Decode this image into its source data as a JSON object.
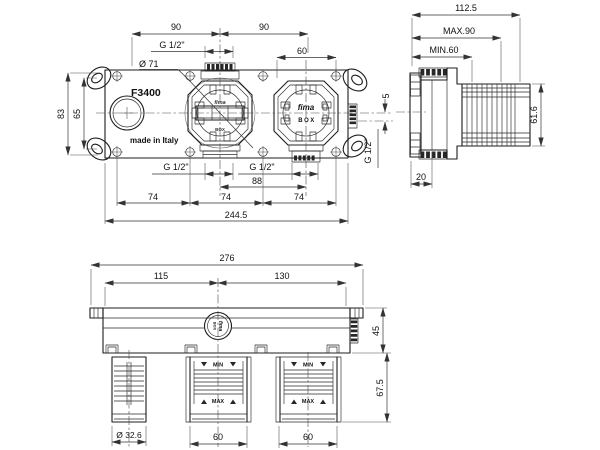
{
  "front_view": {
    "model_label": "F3400",
    "origin_label": "made in Italy",
    "valve_mid_brand_top": "fima",
    "valve_mid_brand_bottom": "BOX",
    "valve_right_brand_top": "fima",
    "valve_right_brand_bottom": "BOX",
    "dim_span_left": "90",
    "dim_span_right": "90",
    "dim_port_top": "G 1/2\"",
    "dim_box_width": "60",
    "dim_diameter": "Ø 71",
    "dim_plate_height": "83",
    "dim_ear_spacing": "65",
    "dim_side_offset": "5",
    "dim_port_side": "G 1/2\"",
    "dim_port_bottom_mid": "G 1/2\"",
    "dim_port_bottom_right": "G 1/2\"",
    "dim_port_spacing": "88",
    "dim_screw_1": "74",
    "dim_screw_2": "74",
    "dim_screw_3": "74",
    "dim_total_width": "244.5"
  },
  "side_view": {
    "dim_depth_total": "112.5",
    "dim_depth_max": "MAX.90",
    "dim_depth_min": "MIN.60",
    "dim_height": "61.6",
    "dim_plate_depth": "20"
  },
  "bottom_view": {
    "logo_top": "fima",
    "logo_bottom": "BOX",
    "dim_total_width": "276",
    "dim_left_span": "115",
    "dim_right_span": "130",
    "dim_body_depth": "45",
    "dim_conn_length": "67.5",
    "dim_cyl_diameter": "Ø 32.6",
    "dim_conn_mid_width": "60",
    "dim_conn_right_width": "60",
    "marker_min_mid": "MIN",
    "marker_max_mid": "MAX",
    "marker_min_right": "MIN",
    "marker_max_right": "MAX"
  }
}
